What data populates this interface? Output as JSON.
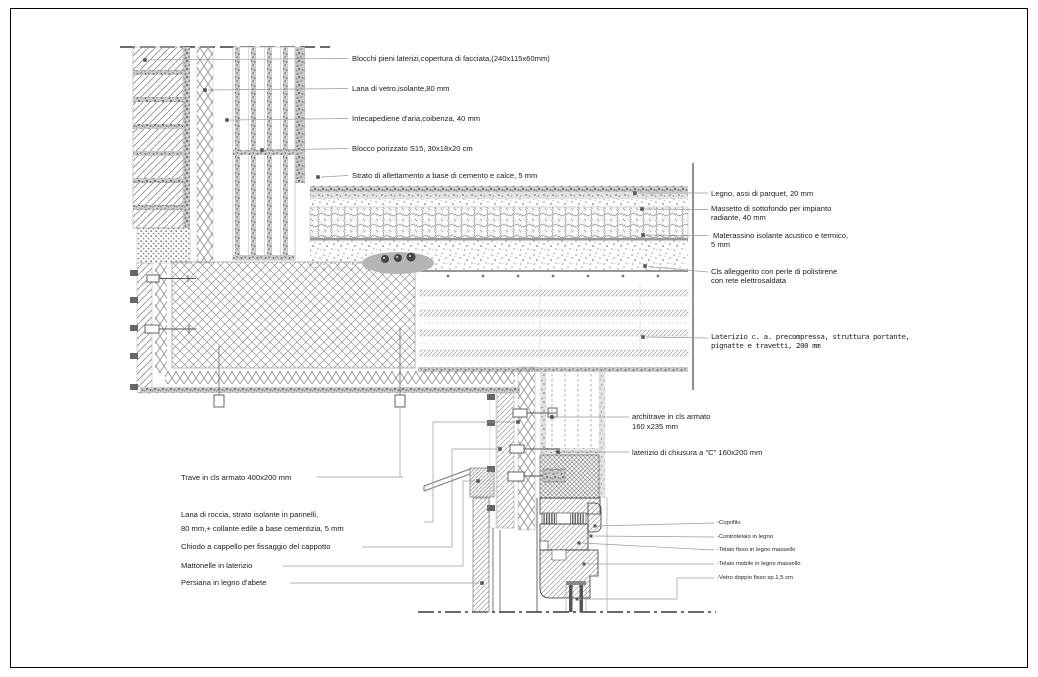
{
  "drawing": {
    "kind": "architectural-construction-detail-section",
    "colors": {
      "line": "#1a1a1a",
      "hatch": "#8a8a8a",
      "leader": "#9a9a9a",
      "speckle": "#5f5f5f",
      "conduit_fill": "#b5b5b5",
      "background": "#ffffff"
    }
  },
  "labels_top": [
    "Blocchi pieni laterizi,copertura di facciata,(240x115x60mm)",
    "Lana di vetro,isolante,80 mm",
    "Intecapediene d'aria,coibenza, 40 mm",
    "Blocco porizzato S15, 30x18x20 cm",
    "Strato di allettamento a base di cemento e calce, 5 mm"
  ],
  "labels_right": [
    {
      "l1": "Legno, assi di parquet, 20 mm",
      "l2": ""
    },
    {
      "l1": "Massetto di sottofondo per impianto",
      "l2": "radiante, 40 mm"
    },
    {
      "l1": "Materassino isolante acustico e termico,",
      "l2": "5 mm"
    },
    {
      "l1": "Cls alleggerito con perle di polistirene",
      "l2": "con rete elettrosaldata"
    },
    {
      "l1": "Laterizio c. a. precompressa, struttura portante,",
      "l2": "pignatte e travetti, 200 mm"
    }
  ],
  "labels_mid": [
    {
      "l1": "architrave in cls armato",
      "l2": "160 x235 mm"
    },
    {
      "l1": "laterizio di chiusura a \"C\" 160x200 mm",
      "l2": ""
    }
  ],
  "labels_bottom_left": [
    {
      "l1": "Trave in cls armato 400x200 mm",
      "l2": ""
    },
    {
      "l1": "Lana di roccia, strato isolante in pannelli,",
      "l2": "80 mm,+ collante edile a base cementizia, 5 mm"
    },
    {
      "l1": "Chiodo a cappello per fissaggio del cappotto",
      "l2": ""
    },
    {
      "l1": "Mattonelle in laterizio",
      "l2": ""
    },
    {
      "l1": "Persiana in legno d'abete",
      "l2": ""
    }
  ],
  "labels_window": [
    "-Coprifilo",
    "-Controtelaio in legno",
    "-Telaio fisso in legno massello",
    "-Telaio mobile in legno massello",
    "-Vetro doppio fisso sp.1,5 cm"
  ]
}
